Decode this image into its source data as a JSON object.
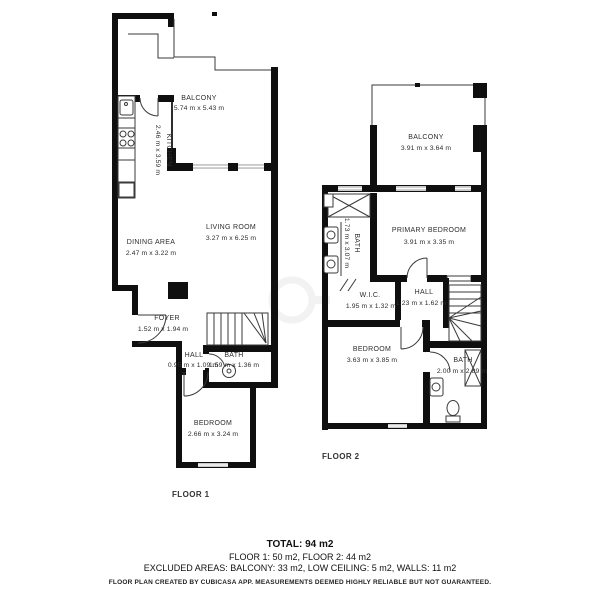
{
  "floor1": {
    "label": "FLOOR 1",
    "rooms": {
      "balcony": {
        "name": "BALCONY",
        "dims": "5.74 m x 5.43 m"
      },
      "kitchen": {
        "name": "KITCHEN",
        "dims": "2.46 m x 3.59 m"
      },
      "living_room": {
        "name": "LIVING ROOM",
        "dims": "3.27 m x 6.25 m"
      },
      "dining_area": {
        "name": "DINING AREA",
        "dims": "2.47 m x 3.22 m"
      },
      "foyer": {
        "name": "FOYER",
        "dims": "1.52 m x 1.94 m"
      },
      "hall": {
        "name": "HALL",
        "dims": "0.95 m x 1.09 m"
      },
      "bath": {
        "name": "BATH",
        "dims": "1.59 m x 1.36 m"
      },
      "bedroom": {
        "name": "BEDROOM",
        "dims": "2.66 m x 3.24 m"
      }
    }
  },
  "floor2": {
    "label": "FLOOR 2",
    "rooms": {
      "balcony": {
        "name": "BALCONY",
        "dims": "3.91 m x 3.64 m"
      },
      "primary_bedroom": {
        "name": "PRIMARY BEDROOM",
        "dims": "3.91 m x 3.35 m"
      },
      "bath_upper": {
        "name": "BATH",
        "dims": "1.73 m x 3.07 m"
      },
      "wic": {
        "name": "W.I.C.",
        "dims": "1.95 m x 1.32 m"
      },
      "hall": {
        "name": "HALL",
        "dims": "1.23 m x 1.62 m"
      },
      "bedroom": {
        "name": "BEDROOM",
        "dims": "3.63 m x 3.85 m"
      },
      "bath_lower": {
        "name": "BATH",
        "dims": "2.00 m x 2.89 m"
      }
    }
  },
  "summary": {
    "total": "TOTAL: 94 m2",
    "floors": "FLOOR 1: 50 m2, FLOOR 2: 44 m2",
    "excluded": "EXCLUDED AREAS: BALCONY: 33 m2, LOW CEILING: 5 m2, WALLS: 11 m2",
    "disclaimer": "FLOOR PLAN CREATED BY CUBICASA APP. MEASUREMENTS DEEMED HIGHLY RELIABLE BUT NOT GUARANTEED."
  },
  "colors": {
    "wall": "#0f0f0f",
    "window": "#c9c9c9",
    "text": "#2e2e2e"
  }
}
